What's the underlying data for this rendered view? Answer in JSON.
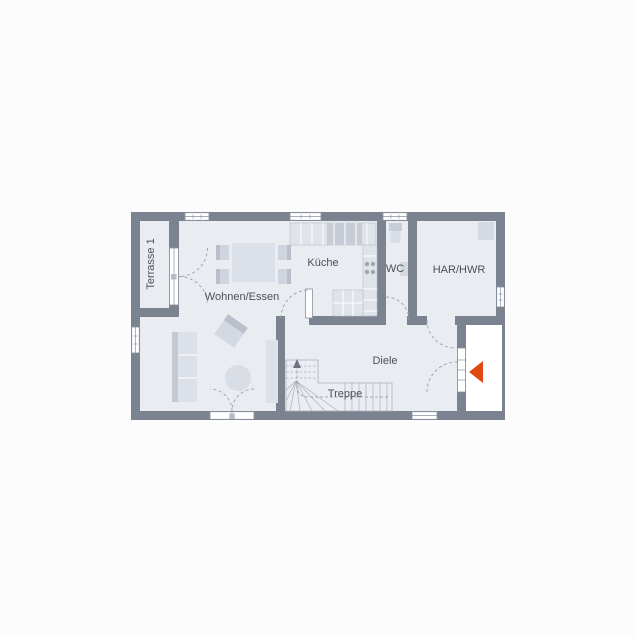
{
  "colors": {
    "wall": "#7b8391",
    "floor": "#e9edf2",
    "page_background": "#fcfcfd",
    "furniture_light": "#dde1e9",
    "furniture_dark": "#c3c8d3",
    "door_arc": "#9aa1ad",
    "entrance_arrow": "#de4a12",
    "label_text": "#4b5058"
  },
  "rooms": {
    "terrasse": {
      "label": "Terrasse 1"
    },
    "wohnen_essen": {
      "label": "Wohnen/Essen"
    },
    "kueche": {
      "label": "Küche"
    },
    "wc": {
      "label": "WC"
    },
    "har_hwr": {
      "label": "HAR/HWR"
    },
    "diele": {
      "label": "Diele"
    },
    "treppe": {
      "label": "Treppe"
    }
  }
}
